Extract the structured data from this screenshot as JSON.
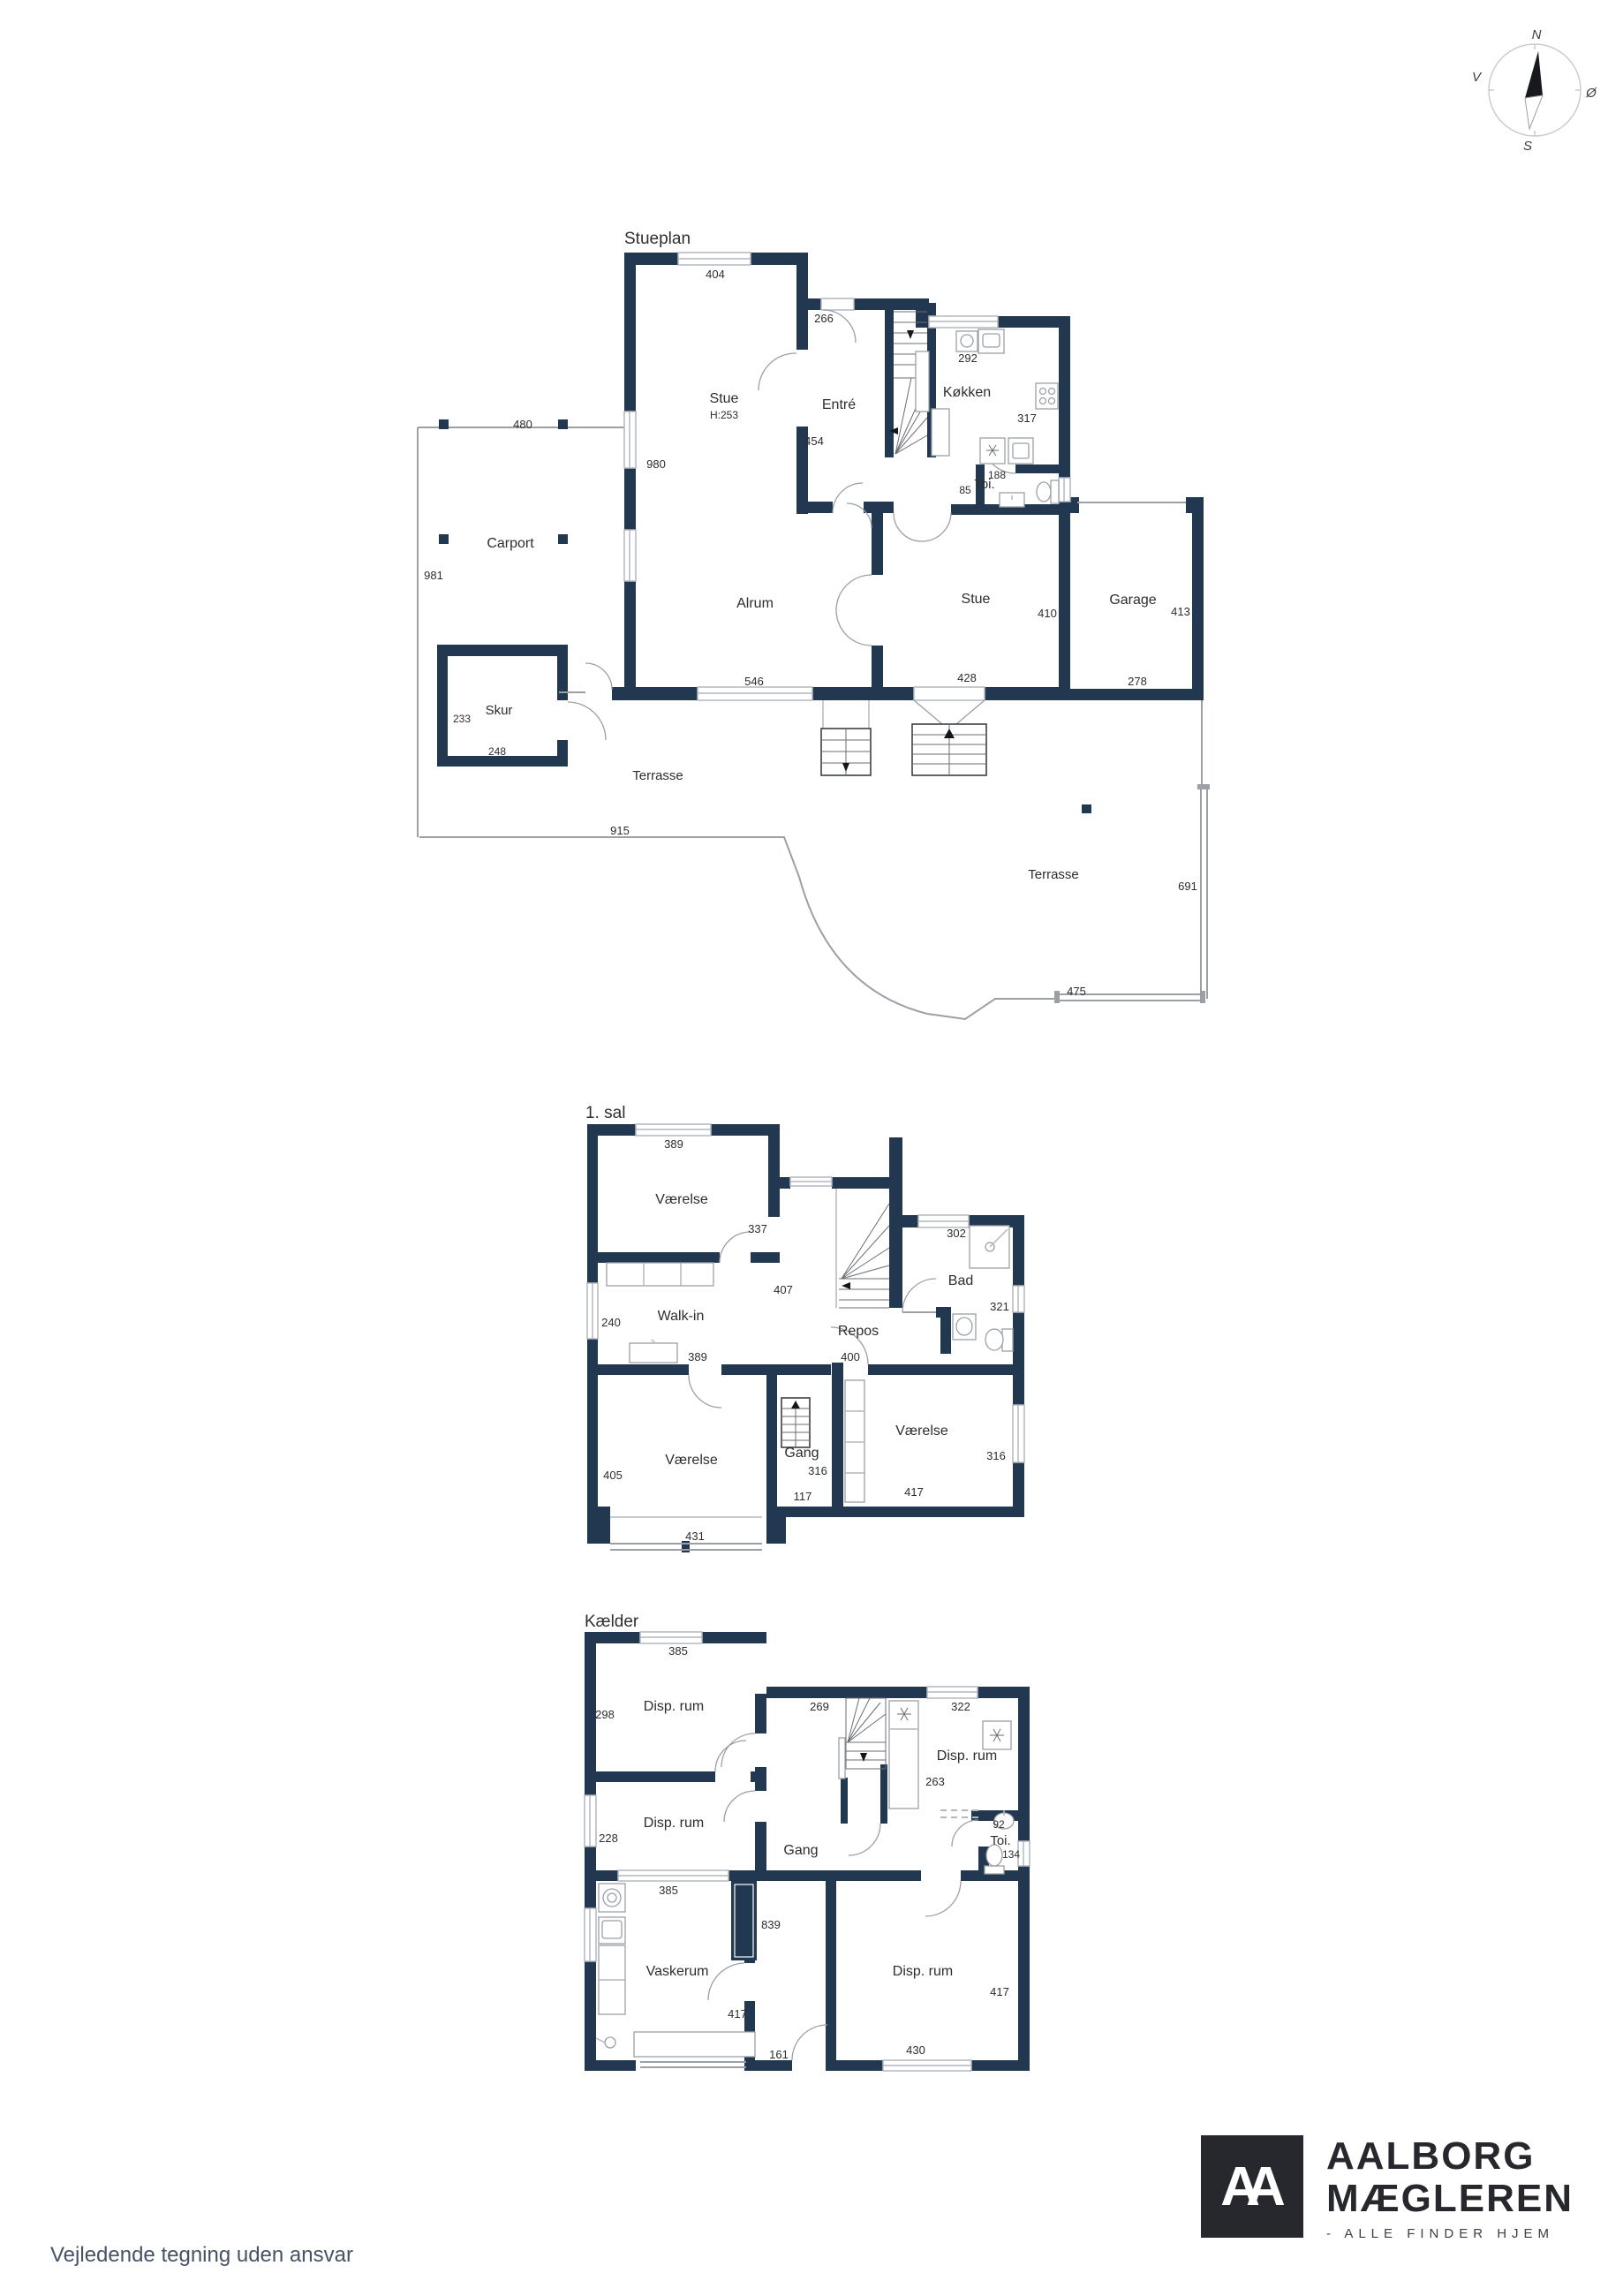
{
  "compass": {
    "north": "N",
    "south": "S",
    "east": "Ø",
    "west": "V"
  },
  "footer": {
    "disclaimer": "Vejledende tegning uden ansvar"
  },
  "brand": {
    "monogram": "AA",
    "name_line1": "AALBORG",
    "name_line2": "MÆGLEREN",
    "tagline": "- ALLE FINDER HJEM"
  },
  "colors": {
    "wall": "#223850",
    "line": "#9aa0a6",
    "text": "#2d2d2d",
    "brand": "#26282d",
    "disclaimer": "#475266"
  },
  "stueplan": {
    "title": "Stueplan",
    "rooms": {
      "stue1": "Stue",
      "stue1_height": "H:253",
      "entre": "Entré",
      "kokken": "Køkken",
      "toi": "Toi.",
      "alrum": "Alrum",
      "stue2": "Stue",
      "garage": "Garage",
      "carport": "Carport",
      "skur": "Skur",
      "terrasse1": "Terrasse",
      "terrasse2": "Terrasse"
    },
    "dims": {
      "stue1_window": "404",
      "entre_door": "266",
      "kokken_width": "292",
      "kokken_depth": "317",
      "toi_width": "188",
      "toi_depth": "85",
      "entre_depth": "454",
      "west_wall": "980",
      "carport_width": "480",
      "carport_depth": "981",
      "skur_depth": "233",
      "skur_width": "248",
      "alrum_window": "546",
      "stue2_door": "428",
      "stue2_depth": "410",
      "garage_depth": "413",
      "garage_width": "278",
      "terrasse_width": "915",
      "terrasse2_depth": "691",
      "terrasse2_width": "475"
    }
  },
  "first_floor": {
    "title": "1. sal",
    "rooms": {
      "room1": "Værelse",
      "walkin": "Walk-in",
      "repos": "Repos",
      "bad": "Bad",
      "room2": "Værelse",
      "gang": "Gang",
      "room3": "Værelse"
    },
    "dims": {
      "room1_window": "389",
      "room1_depth": "337",
      "walkin_window": "240",
      "walkin_width": "389",
      "repos_depth": "407",
      "bad_window": "302",
      "bad_depth": "321",
      "repos_width": "400",
      "room2_depth": "405",
      "room2_window": "431",
      "gang_width": "316",
      "gang_depth": "117",
      "room3_width": "417",
      "room3_window": "316"
    }
  },
  "basement": {
    "title": "Kælder",
    "rooms": {
      "disp1": "Disp. rum",
      "disp2": "Disp. rum",
      "gang": "Gang",
      "disp3": "Disp. rum",
      "toi": "Toi.",
      "vaskerum": "Vaskerum",
      "disp4": "Disp. rum"
    },
    "dims": {
      "disp1_window": "385",
      "disp1_depth": "298",
      "gang_top": "269",
      "disp3_window": "322",
      "disp3_depth": "263",
      "disp2_depth": "228",
      "toi_width": "92",
      "toi_depth": "134",
      "vask_window": "385",
      "gang_length": "839",
      "vask_width": "417",
      "door_gap": "161",
      "disp4_window": "430",
      "disp4_depth": "417"
    }
  }
}
